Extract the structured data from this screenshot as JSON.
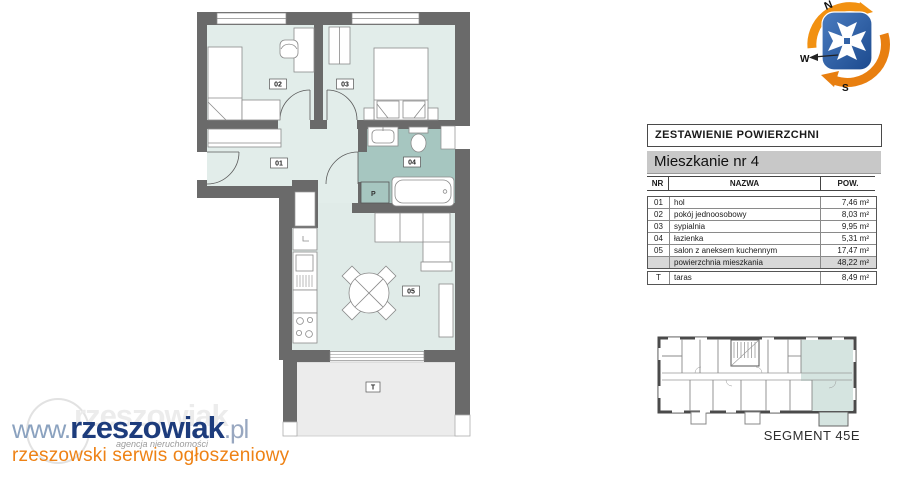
{
  "table": {
    "title": "ZESTAWIENIE POWIERZCHNI",
    "subtitle": "Mieszkanie nr 4",
    "columns": {
      "nr": "NR",
      "nazwa": "NAZWA",
      "pow": "POW."
    },
    "rows": [
      {
        "nr": "01",
        "nazwa": "hol",
        "pow": "7,46 m²"
      },
      {
        "nr": "02",
        "nazwa": "pokój jednoosobowy",
        "pow": "8,03 m²"
      },
      {
        "nr": "03",
        "nazwa": "sypialnia",
        "pow": "9,95 m²"
      },
      {
        "nr": "04",
        "nazwa": "łazienka",
        "pow": "5,31 m²"
      },
      {
        "nr": "05",
        "nazwa": "salon z aneksem kuchennym",
        "pow": "17,47 m²"
      },
      {
        "nr": "",
        "nazwa": "powierzchnia mieszkania",
        "pow": "48,22 m²"
      }
    ],
    "taras_row": {
      "nr": "T",
      "nazwa": "taras",
      "pow": "8,49 m²"
    }
  },
  "plan": {
    "labels": {
      "r01": "01",
      "r02": "02",
      "r03": "03",
      "r04": "04",
      "r05": "05",
      "taras": "T",
      "pralka": "P"
    }
  },
  "segment": {
    "label": "SEGMENT 45E"
  },
  "compass": {
    "n": "N",
    "w": "W",
    "s": "S"
  },
  "logo": {
    "www": "www.",
    "name": "rzeszowiak",
    "tld": ".pl",
    "caption": "agencja nieruchomości",
    "tagline": "rzeszowski serwis ogłoszeniowy"
  },
  "colors": {
    "wall": "#6a6a6a",
    "room_fill": "#e2edea",
    "bathroom_fill": "#a6c6c0",
    "terrace_fill": "#ececec",
    "highlight_unit": "#d5e4e0",
    "brand_navy": "#1d3c7c",
    "brand_orange": "#ee8215",
    "compass_orange": "#f29111",
    "compass_blue": "#2e5ea8"
  }
}
